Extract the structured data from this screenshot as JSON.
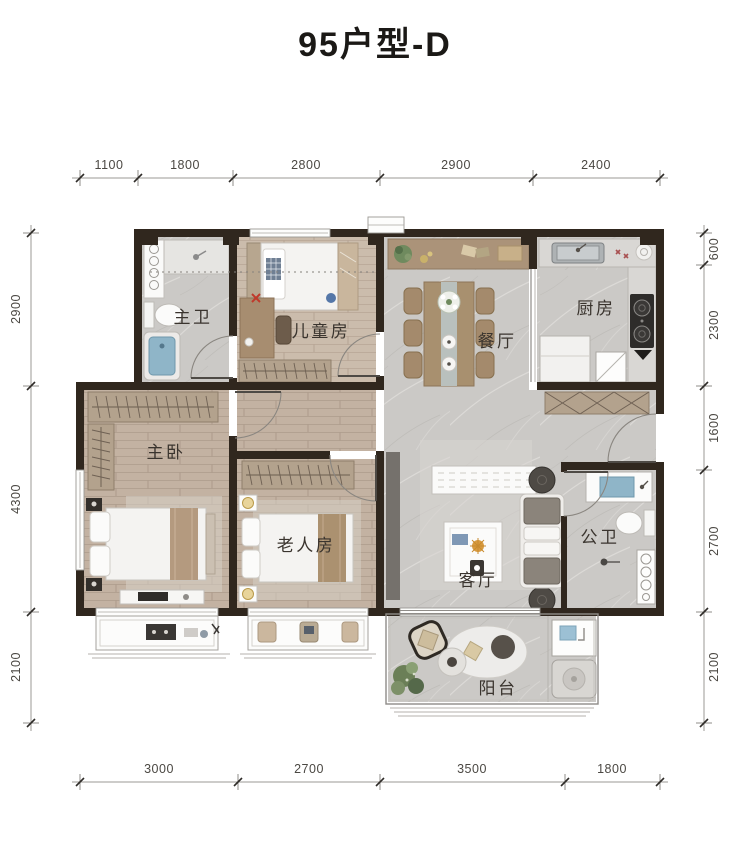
{
  "title": "95户型-D",
  "dimensions": {
    "top": [
      "1100",
      "1800",
      "2800",
      "2900",
      "2400"
    ],
    "bottom": [
      "3000",
      "2700",
      "3500",
      "1800"
    ],
    "left": [
      "2900",
      "4300",
      "2100"
    ],
    "right": [
      "600",
      "2300",
      "1600",
      "2700",
      "2100"
    ]
  },
  "rooms": [
    {
      "id": "master-bath",
      "label": "主卫"
    },
    {
      "id": "kids-room",
      "label": "儿童房"
    },
    {
      "id": "dining-room",
      "label": "餐厅"
    },
    {
      "id": "kitchen",
      "label": "厨房"
    },
    {
      "id": "master-bedroom",
      "label": "主卧"
    },
    {
      "id": "elder-room",
      "label": "老人房"
    },
    {
      "id": "living-room",
      "label": "客厅"
    },
    {
      "id": "guest-bath",
      "label": "公卫"
    },
    {
      "id": "balcony",
      "label": "阳台"
    }
  ],
  "colors": {
    "wall": "#30271e",
    "wood_floor": "#c3b2a2",
    "marble_floor": "#cbc9c6",
    "cabinet_tan": "#b3a28d",
    "bathtub_blue": "#8fb5c8",
    "title_ink": "#1b1916",
    "dim_ink": "#4b4843"
  }
}
